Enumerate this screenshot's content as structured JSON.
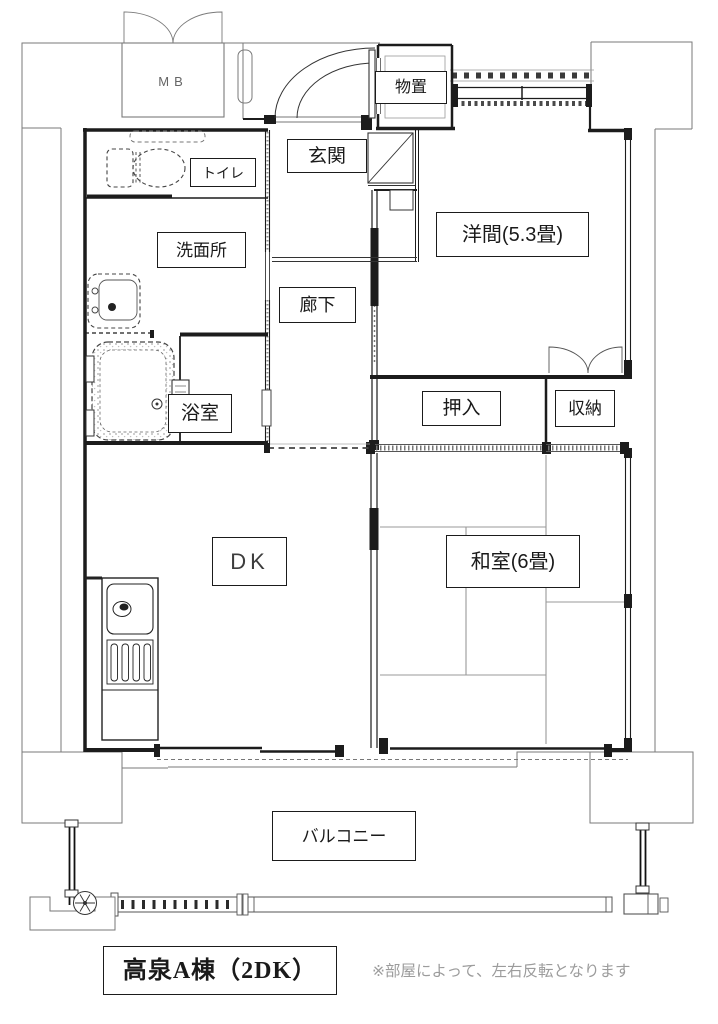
{
  "floorplan": {
    "labels": {
      "mb": "MB",
      "storage_top": "物置",
      "entrance": "玄関",
      "toilet": "トイレ",
      "washroom": "洗面所",
      "hallway": "廊下",
      "western_room": "洋間(5.3畳)",
      "bathroom": "浴室",
      "futon_closet": "押入",
      "storage_closet": "収納",
      "dining_kitchen": "DK",
      "japanese_room": "和室(6畳)",
      "balcony": "バルコニー"
    },
    "footer": {
      "unit_name": "高泉A棟（2DK）",
      "note": "※部屋によって、左右反転となります"
    },
    "colors": {
      "wall": "#1c1c1c",
      "outline": "#7a7a7a",
      "background": "#ffffff",
      "note_text": "#9c9c9c"
    }
  }
}
